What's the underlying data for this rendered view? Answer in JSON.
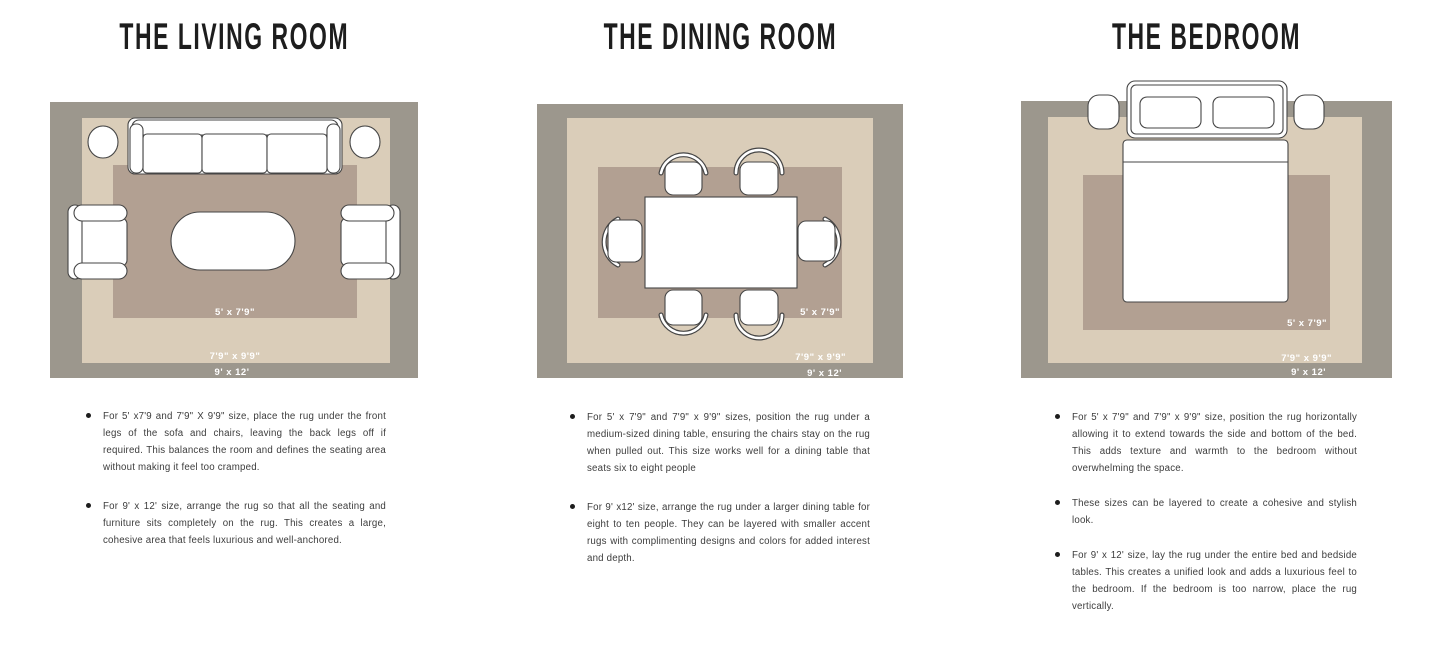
{
  "colors": {
    "page_bg": "#ffffff",
    "rug_outer": "#9c978d",
    "rug_middle": "#dacdb9",
    "rug_inner": "#b2a092",
    "furniture_fill": "#ffffff",
    "furniture_stroke": "#454545",
    "title_text": "#1d1d1d",
    "body_text": "#3c3c3c",
    "label_text": "#ffffff"
  },
  "sections": [
    {
      "id": "living-room",
      "title": "THE LIVING ROOM",
      "rug_labels": {
        "inner": "5' x 7'9\"",
        "middle": "7'9\" x 9'9\"",
        "outer": "9' x 12'"
      },
      "bullets": [
        "For 5' x7'9 and 7'9\" X 9'9\" size, place the rug under the front legs of the sofa and chairs, leaving the back legs off if required. This balances the room and defines the seating area without making it feel too cramped.",
        "For 9' x 12' size, arrange the rug so that all the seating and furniture sits completely on the rug. This creates a large, cohesive area that feels luxurious and well-anchored."
      ]
    },
    {
      "id": "dining-room",
      "title": "THE DINING ROOM",
      "rug_labels": {
        "inner": "5' x 7'9\"",
        "middle": "7'9\" x 9'9\"",
        "outer": "9' x 12'"
      },
      "bullets": [
        "For 5' x 7'9\" and 7'9\" x 9'9\" sizes, position the rug under a medium-sized dining table, ensuring the chairs stay on the rug when pulled out. This size works well for a dining table that seats six to eight people",
        "For 9' x12' size, arrange the rug under a larger dining table for eight to ten people. They can be layered with smaller accent rugs with complimenting designs and colors for added interest and depth."
      ]
    },
    {
      "id": "bedroom",
      "title": "THE BEDROOM",
      "rug_labels": {
        "inner": "5' x 7'9\"",
        "middle": "7'9\" x 9'9\"",
        "outer": "9' x 12'"
      },
      "bullets": [
        "For 5' x 7'9\" and 7'9\" x 9'9\" size, position the rug horizontally allowing it to extend towards the side and bottom of the bed. This adds texture and warmth to the bedroom without overwhelming the space.",
        "These sizes can be layered to create a cohesive and stylish look.",
        "For 9' x 12' size, lay the rug under the entire bed and bedside tables. This creates a unified look and adds a luxurious feel to the bedroom. If the bedroom is too narrow, place the rug vertically."
      ]
    }
  ]
}
